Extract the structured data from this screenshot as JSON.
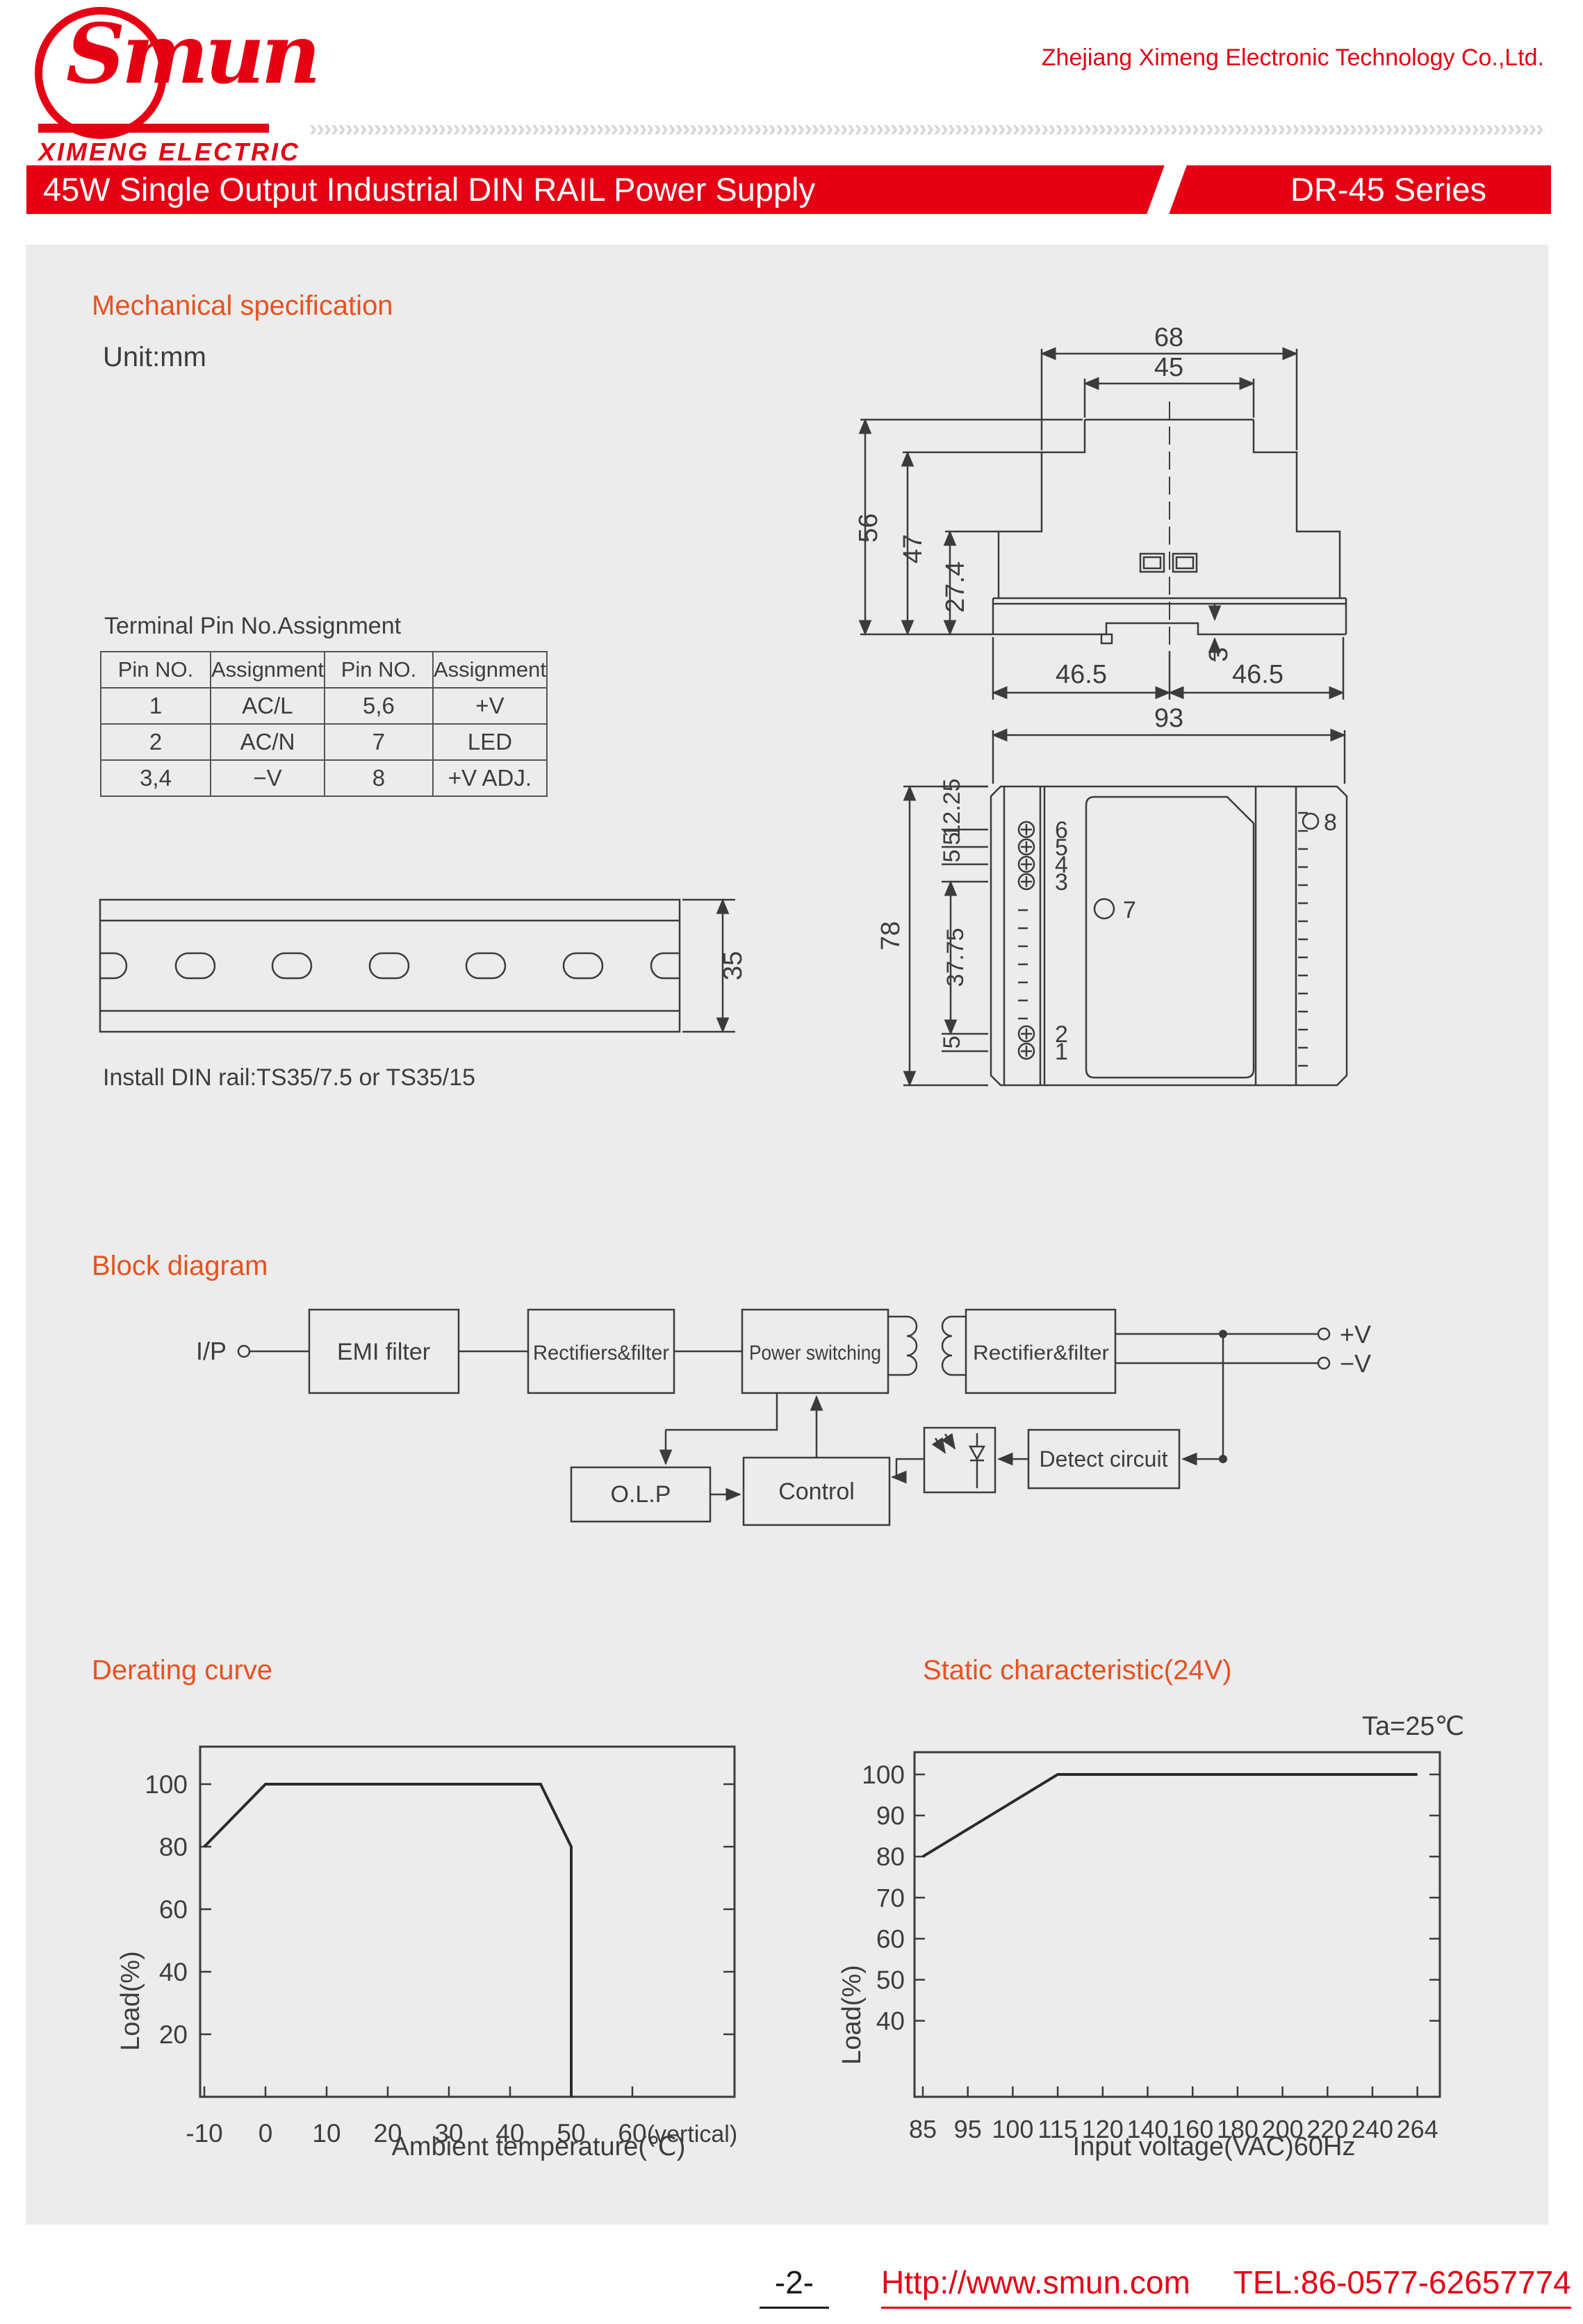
{
  "header": {
    "logo": {
      "name": "Smun",
      "subtitle": "XIMENG ELECTRIC"
    },
    "company": "Zhejiang Ximeng Electronic Technology Co.,Ltd.",
    "banner": {
      "title": "45W Single Output Industrial DIN RAIL Power Supply",
      "series": "DR-45 Series"
    }
  },
  "mechanical": {
    "title": "Mechanical specification",
    "unit": "Unit:mm",
    "side_view": {
      "d68": "68",
      "d45": "45",
      "d56": "56",
      "d47": "47",
      "d27_4": "27.4",
      "d3": "3",
      "d46_5_left": "46.5",
      "d46_5_right": "46.5"
    },
    "front_view": {
      "d93": "93",
      "d78": "78",
      "chain_top": [
        "12.25",
        "5",
        "5"
      ],
      "chain_mid": "37.75",
      "chain_bottom": "5",
      "terminals_top": [
        "6",
        "5",
        "4",
        "3"
      ],
      "terminals_bottom": [
        "2",
        "1"
      ],
      "led_label": "7",
      "adj_label": "8"
    },
    "pin_table": {
      "title": "Terminal Pin No.Assignment",
      "headers": [
        "Pin NO.",
        "Assignment",
        "Pin NO.",
        "Assignment"
      ],
      "rows": [
        [
          "1",
          "AC/L",
          "5,6",
          "+V"
        ],
        [
          "2",
          "AC/N",
          "7",
          "LED"
        ],
        [
          "3,4",
          "−V",
          "8",
          "+V ADJ."
        ]
      ]
    },
    "din_rail": {
      "d35": "35",
      "note": "Install DIN rail:TS35/7.5 or TS35/15"
    }
  },
  "block_diagram": {
    "title": "Block diagram",
    "input_label": "I/P",
    "blocks": [
      "EMI filter",
      "Rectifiers&filter",
      "Power switching",
      "Rectifier&filter",
      "O.L.P",
      "Control",
      "Detect circuit"
    ],
    "outputs": [
      "+V",
      "−V"
    ]
  },
  "chart_data": [
    {
      "type": "line",
      "title": "Derating curve",
      "xlabel": "Ambient temperature(℃)",
      "ylabel": "Load(%)",
      "x_ticks": [
        -10,
        0,
        10,
        20,
        30,
        40,
        50,
        60
      ],
      "x_extra_label": "(vertical)",
      "y_ticks": [
        20,
        40,
        60,
        80,
        100
      ],
      "xlim": [
        -10,
        77
      ],
      "ylim": [
        0,
        112
      ],
      "grid": false,
      "series": [
        {
          "name": "Load",
          "points": [
            [
              -10,
              80
            ],
            [
              0,
              100
            ],
            [
              45,
              100
            ],
            [
              50,
              80
            ],
            [
              50,
              0
            ]
          ]
        }
      ]
    },
    {
      "type": "line",
      "title": "Static characteristic(24V)",
      "note": "Ta=25℃",
      "xlabel": "Input voltage(VAC)60Hz",
      "ylabel": "Load(%)",
      "x_tick_labels": [
        "85",
        "95",
        "100",
        "115",
        "120",
        "140",
        "160",
        "180",
        "200",
        "220",
        "240",
        "264"
      ],
      "y_ticks": [
        40,
        50,
        60,
        70,
        80,
        90,
        100
      ],
      "ylim": [
        20,
        105
      ],
      "grid": false,
      "series": [
        {
          "name": "Load",
          "points_by_tick_index": [
            [
              0,
              80
            ],
            [
              3,
              100
            ],
            [
              11,
              100
            ]
          ]
        }
      ]
    }
  ],
  "footer": {
    "page": "-2-",
    "link": "Http://www.smun.com",
    "tel": "TEL:86-0577-62657774"
  }
}
